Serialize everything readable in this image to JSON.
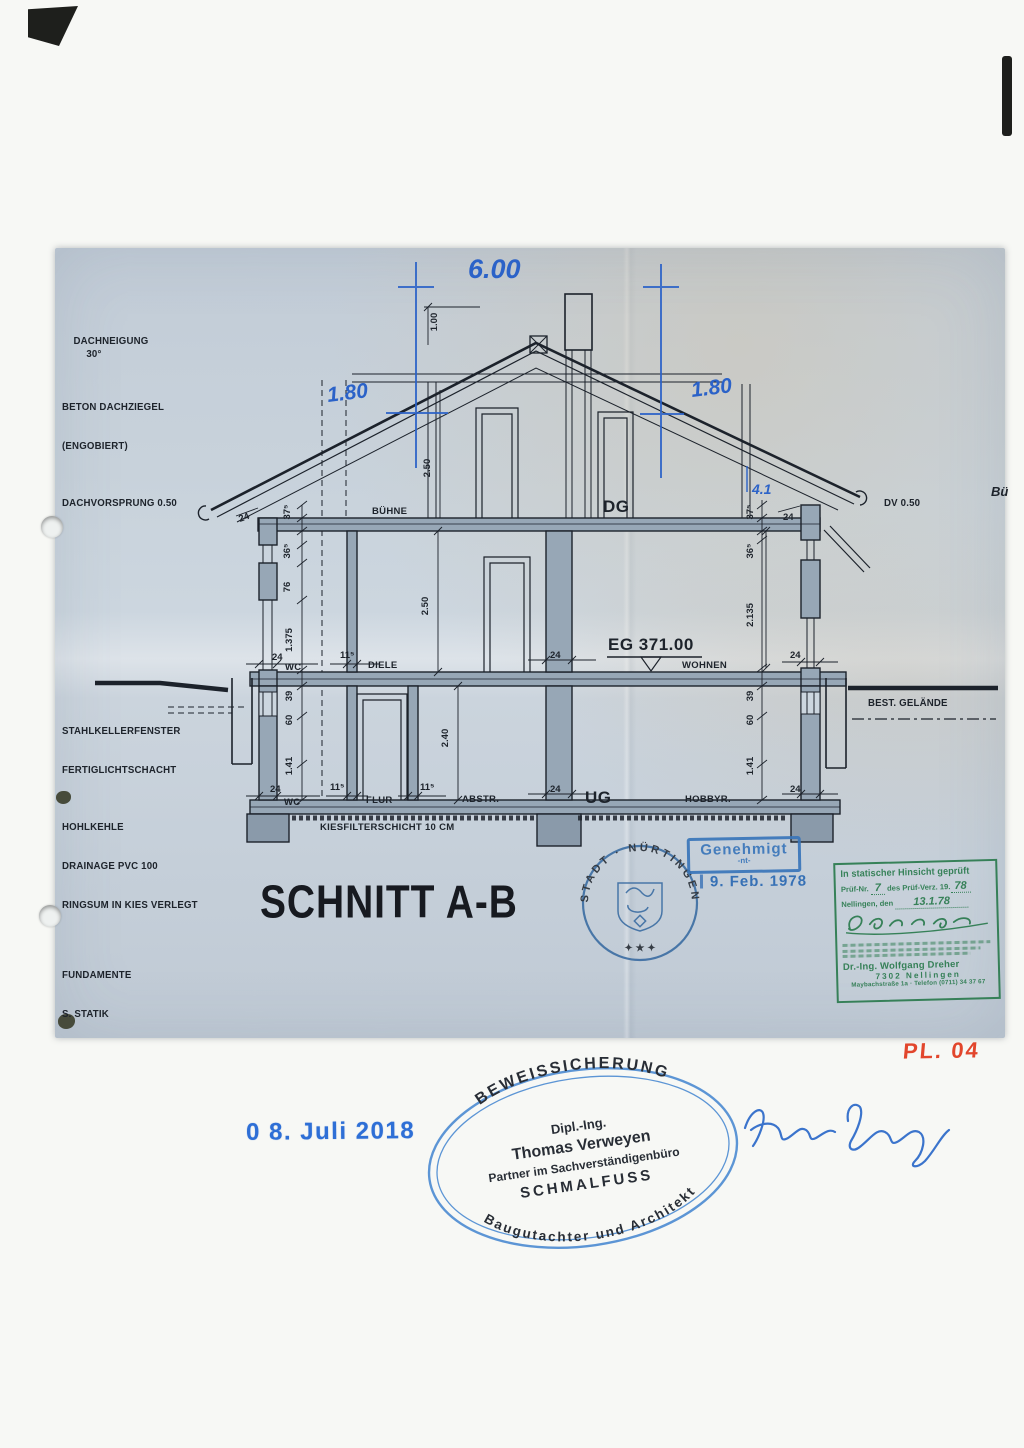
{
  "page": {
    "plan_no": "PL. 04",
    "edge_note": "Bü"
  },
  "title": "SCHNITT A-B",
  "colors": {
    "ink": "#1d232b",
    "pen_blue": "#2b62c8",
    "stamp_blue": "#5490d4",
    "seal_blue": "#33679f",
    "stamp_green": "#2f7d52",
    "plan_red": "#e2462c",
    "paper_blue": "#c8d2db"
  },
  "margin": {
    "dachneigung": "DACHNEIGUNG",
    "dachneigung_value": "30°",
    "dachziegel1": "BETON DACHZIEGEL",
    "dachziegel2": "(ENGOBIERT)",
    "dachvorsprung": "DACHVORSPRUNG 0.50",
    "dv": "DV 0.50",
    "kellerfenster1": "STAHLKELLERFENSTER",
    "kellerfenster2": "FERTIGLICHTSCHACHT",
    "hohlkehle": "HOHLKEHLE",
    "drainage": "DRAINAGE PVC 100",
    "ringsum": "RINGSUM IN KIES VERLEGT",
    "fundamente": "FUNDAMENTE",
    "statik": "S. STATIK",
    "gelaende": "BEST. GELÄNDE",
    "kiesfilter": "KIESFILTERSCHICHT 10 CM"
  },
  "rooms": {
    "buehne": "BÜHNE",
    "dg": "DG",
    "wc_eg": "WC",
    "diele": "DIELE",
    "wohnen": "WOHNEN",
    "eg_level": "EG 371.00",
    "wc_ug": "WC",
    "flur": "FLUR",
    "abstr": "ABSTR.",
    "ug": "UG",
    "hobbyr": "HOBBYR."
  },
  "dims": {
    "width_top": "6.00",
    "roof_left": "1.80",
    "roof_right": "1.80",
    "ridge": "1.00",
    "roof_h": "2.50",
    "dg_h": "2.50",
    "ug_h": "2.40",
    "eg_left": "1.375",
    "eg_right": "2.135",
    "d24": "24",
    "d375": "37⁵",
    "d365": "36⁵",
    "d76": "76",
    "d115": "11⁵",
    "d39": "39",
    "d60": "60",
    "d141": "1.41",
    "hand41": "4.1"
  },
  "stamps": {
    "genehmigt": {
      "label": "Genehmigt",
      "sub": "-nt-",
      "date": "9. Feb. 1978"
    },
    "seal": {
      "ring": "STADT · NÜRTINGEN",
      "stars": "✦ ★ ✦"
    },
    "pruef": {
      "title": "In statischer Hinsicht geprüft",
      "row1a": "Prüf-Nr.",
      "row1v": "7",
      "row1b": "des Prüf-Verz. 19.",
      "row1v2": "78",
      "row2a": "Nellingen, den",
      "row2v": "13.1.78",
      "name": "Dr.-Ing. Wolfgang Dreher",
      "city": "7302 Nellingen",
      "address": "Maybachstraße 1a  ·  Telefon (0711) 34 37 67"
    },
    "oval": {
      "arc_top": "BEWEISSICHERUNG",
      "l1": "Dipl.-Ing.",
      "l2": "Thomas Verweyen",
      "l3": "Partner im Sachverständigenbüro",
      "l4": "SCHMALFUSS",
      "arc_bottom": "Baugutachter und Architekt"
    },
    "date2018": "0 8. Juli 2018",
    "signature_name": "Thomas Verweyen"
  }
}
